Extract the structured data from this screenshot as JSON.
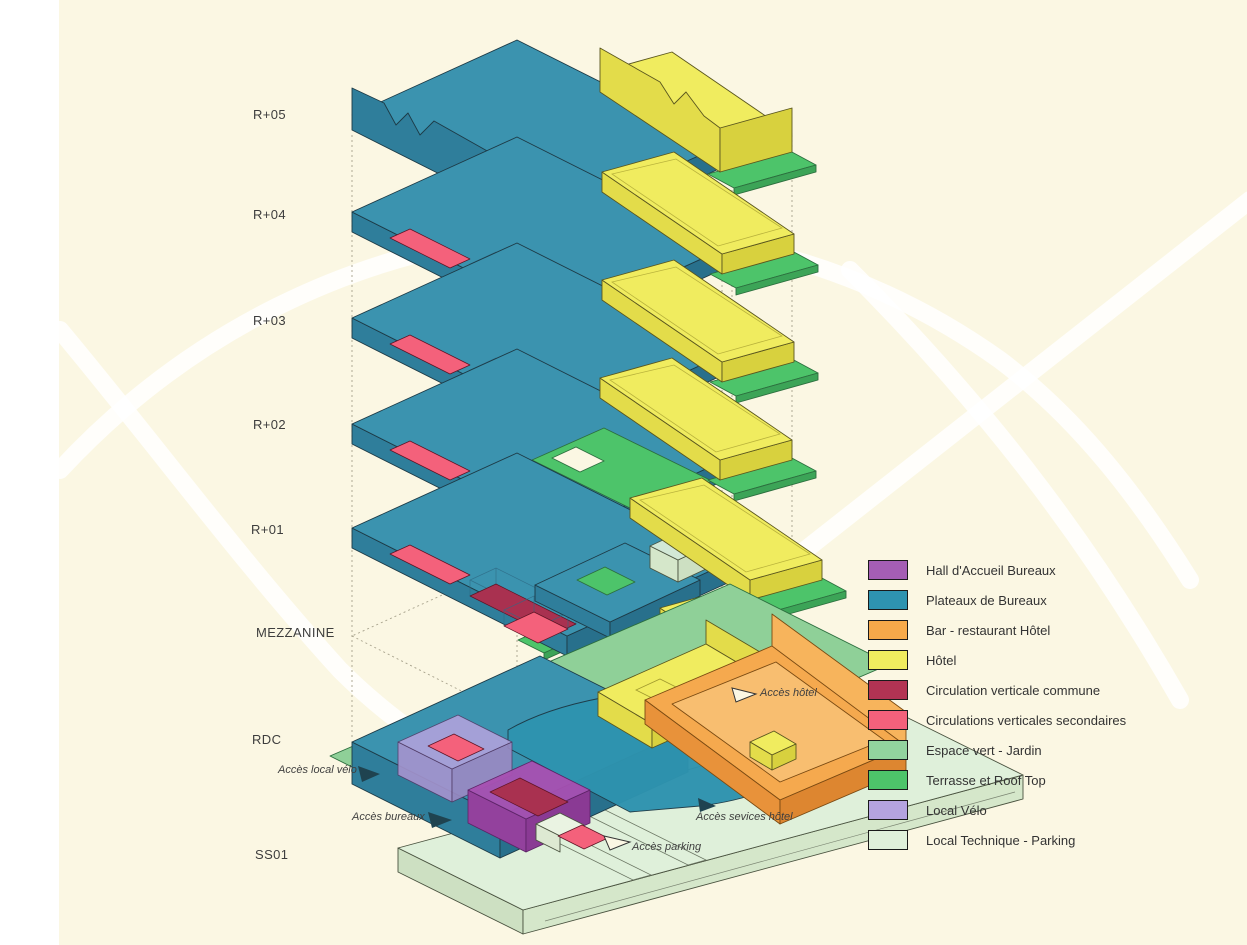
{
  "background": {
    "page": "#FFFFFF",
    "canvas": "#FBF7E3",
    "swoosh": "#FFFFFF"
  },
  "floors": [
    {
      "id": "r05",
      "label": "R+05"
    },
    {
      "id": "r04",
      "label": "R+04"
    },
    {
      "id": "r03",
      "label": "R+03"
    },
    {
      "id": "r02",
      "label": "R+02"
    },
    {
      "id": "r01",
      "label": "R+01"
    },
    {
      "id": "mezzanine",
      "label": "MEZZANINE"
    },
    {
      "id": "rdc",
      "label": "RDC"
    },
    {
      "id": "ss01",
      "label": "SS01"
    }
  ],
  "legend": {
    "items": [
      {
        "label": "Hall d'Accueil Bureaux",
        "color": "#A55EB4"
      },
      {
        "label": "Plateaux de Bureaux",
        "color": "#2E93B0"
      },
      {
        "label": "Bar - restaurant Hôtel",
        "color": "#F6A94A"
      },
      {
        "label": "Hôtel",
        "color": "#F0EC5F"
      },
      {
        "label": "Circulation verticale commune",
        "color": "#B23353"
      },
      {
        "label": "Circulations verticales secondaires",
        "color": "#F4617B"
      },
      {
        "label": "Espace vert - Jardin",
        "color": "#92D39E"
      },
      {
        "label": "Terrasse et Roof Top",
        "color": "#4DC46A"
      },
      {
        "label": "Local Vélo",
        "color": "#B4A3DF"
      },
      {
        "label": "Local Technique - Parking",
        "color": "#DFF0DA"
      }
    ]
  },
  "annotations": {
    "local_velo": "Accès local vélo",
    "bureaux": "Accès bureaux",
    "parking": "Accès parking",
    "services_hotel": "Accès sevices hôtel",
    "hotel": "Accès hôtel"
  }
}
